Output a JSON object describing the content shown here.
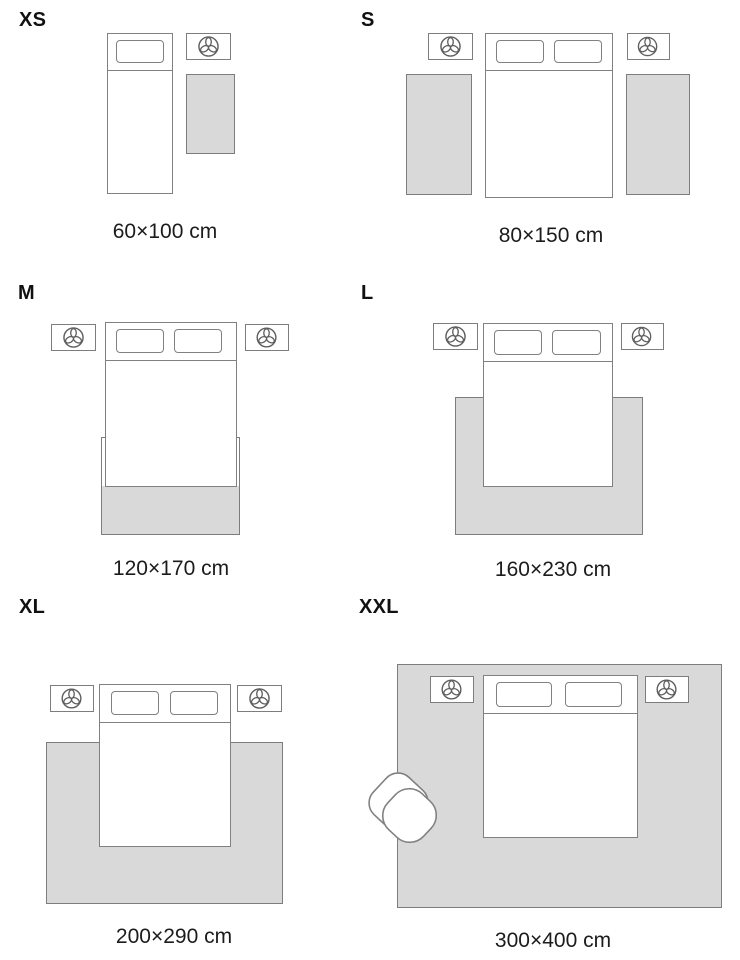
{
  "guide": {
    "colors": {
      "rug_fill": "#d9d9d9",
      "outline_gray": "#7d7d7d",
      "bed_outline": "#818181",
      "text": "#1c1c1c",
      "background": "#ffffff"
    },
    "icons": {
      "nightstand_decor": "plant-icon",
      "seat": "armchair"
    },
    "panels": [
      {
        "id": "xs",
        "size_label": "XS",
        "dimensions": "60×100 cm"
      },
      {
        "id": "s",
        "size_label": "S",
        "dimensions": "80×150 cm"
      },
      {
        "id": "m",
        "size_label": "M",
        "dimensions": "120×170 cm"
      },
      {
        "id": "l",
        "size_label": "L",
        "dimensions": "160×230 cm"
      },
      {
        "id": "xl",
        "size_label": "XL",
        "dimensions": "200×290 cm"
      },
      {
        "id": "xxl",
        "size_label": "XXL",
        "dimensions": "300×400 cm"
      }
    ]
  }
}
